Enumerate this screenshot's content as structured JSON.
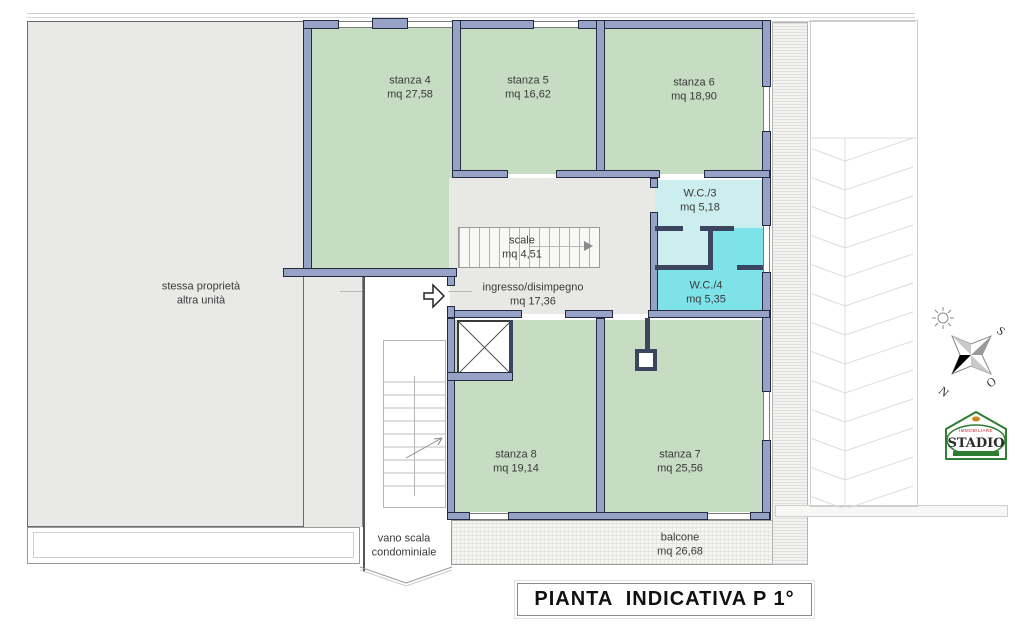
{
  "plan": {
    "title": "PIANTA  INDICATIVA P 1°",
    "rooms": [
      {
        "name": "stanza 4",
        "area": "mq 27,58"
      },
      {
        "name": "stanza 5",
        "area": "mq 16,62"
      },
      {
        "name": "stanza 6",
        "area": "mq 18,90"
      },
      {
        "name": "W.C./3",
        "area": "mq 5,18"
      },
      {
        "name": "W.C./4",
        "area": "mq 5,35"
      },
      {
        "name": "scale",
        "area": "mq 4,51"
      },
      {
        "name": "ingresso/disimpegno",
        "area": "mq 17,36"
      },
      {
        "name": "stanza 8",
        "area": "mq 19,14"
      },
      {
        "name": "stanza 7",
        "area": "mq 25,56"
      },
      {
        "name": "balcone",
        "area": "mq 26,68"
      }
    ],
    "adjacent_property": {
      "line1": "stessa proprietà",
      "line2": "altra unità"
    },
    "stairwell": {
      "line1": "vano scala",
      "line2": "condominiale"
    }
  },
  "compass": {
    "north": "N",
    "south": "S",
    "west": "O"
  },
  "logo": {
    "top_text": "IMMOBILIARE",
    "name": "STADIO"
  },
  "colors": {
    "wall": "#96a3c6",
    "room_green": "#c6dcc3",
    "wc_light": "#cdeeee",
    "wc_cyan": "#7ee3e9",
    "other_unit_gray": "#e9e9e7",
    "hall_gray": "#e8e8e4"
  }
}
